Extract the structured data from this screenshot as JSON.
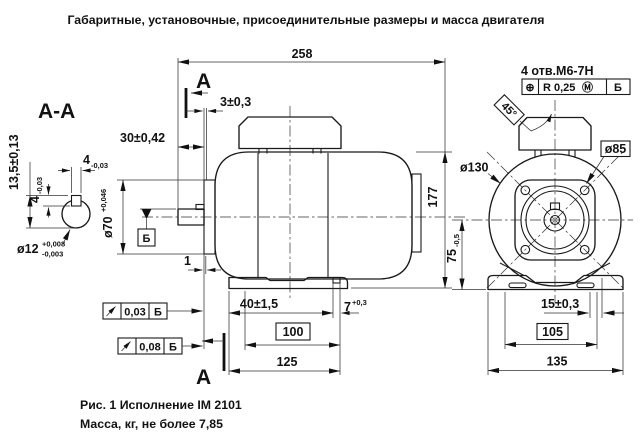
{
  "title": "Габаритные, установочные, присоединительные размеры и масса двигателя",
  "section_view": {
    "label": "А-А",
    "dim_keyway_depth": "13,5±0,13",
    "dim_key_width_nominal": "4",
    "dim_key_width_tol": "-0,03",
    "dim_key_height_nominal": "4",
    "dim_key_height_tol": "-0,03",
    "dim_shaft_dia_nominal": "ø12",
    "dim_shaft_dia_upper": "+0,008",
    "dim_shaft_dia_lower": "-0,003"
  },
  "side_view": {
    "section_label_top": "А",
    "section_label_bottom": "А",
    "dim_overall_length": "258",
    "dim_key_to_face": "3±0,3",
    "dim_shaft_length": "30±0,42",
    "dim_spigot_dia_nominal": "ø70",
    "dim_spigot_dia_upper": "+0,046",
    "datum_label": "Б",
    "dim_face_offset": "1",
    "dim_overall_height": "177",
    "dim_shoulder_to_foot": "40±1,5",
    "dim_foot_slot_nominal": "7",
    "dim_foot_slot_upper": "+0,3",
    "dim_foot_holes_span": "100",
    "dim_base_length": "125",
    "runout_frames": [
      {
        "value": "0,03",
        "datum": "Б"
      },
      {
        "value": "0,08",
        "datum": "Б"
      }
    ]
  },
  "end_view": {
    "holes_note": "4 отв.М6-7Н",
    "position_frame": {
      "symbol": "⊕",
      "value": "R 0,25",
      "modifier": "Ⓜ",
      "datum": "Б"
    },
    "angle_label": "45°",
    "dim_flange_dia": "ø130",
    "dim_bolt_circle": "ø85",
    "dim_axis_height_nominal": "75",
    "dim_axis_height_tol": "-0,5",
    "dim_foot_hole_offset": "15±0,3",
    "dim_foot_holes_span": "105",
    "dim_base_width": "135"
  },
  "caption": {
    "figure": "Рис. 1 Исполнение IM 2101",
    "mass": "Масса, кг, не более 7,85"
  }
}
